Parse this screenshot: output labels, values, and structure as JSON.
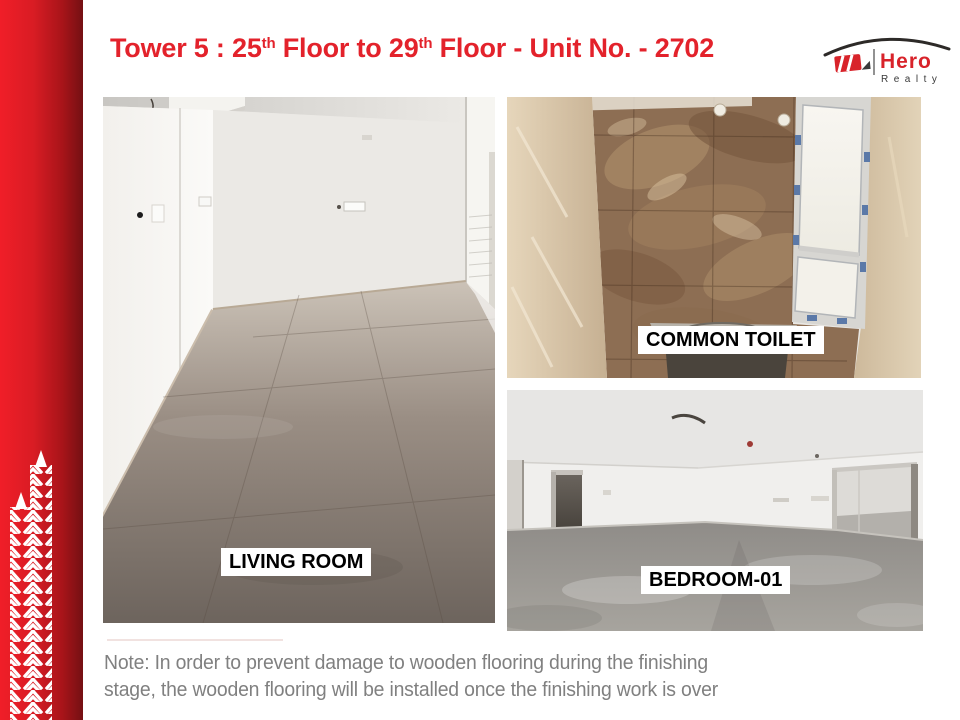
{
  "header": {
    "title_prefix": "Tower 5 : 25",
    "title_sup1": "th",
    "title_mid": " Floor to 29",
    "title_sup2": "th",
    "title_suffix": " Floor - Unit No. - 2702",
    "title_color": "#e3222b"
  },
  "logo": {
    "brand": "Hero",
    "subtitle": "Realty",
    "brand_color": "#d8232a",
    "subtitle_color": "#3a3a3a"
  },
  "photos": {
    "living_room": {
      "label": "LIVING ROOM"
    },
    "common_toilet": {
      "label": "COMMON TOILET"
    },
    "bedroom": {
      "label": "BEDROOM-01"
    }
  },
  "note": {
    "line1": "Note: In order to prevent damage to wooden flooring during the finishing",
    "line2": "stage, the wooden flooring will be installed once the finishing work is over",
    "text_color": "#808080"
  },
  "colors": {
    "accent_bar_red": "#d91c24",
    "label_background": "#ffffff",
    "label_text": "#000000"
  }
}
